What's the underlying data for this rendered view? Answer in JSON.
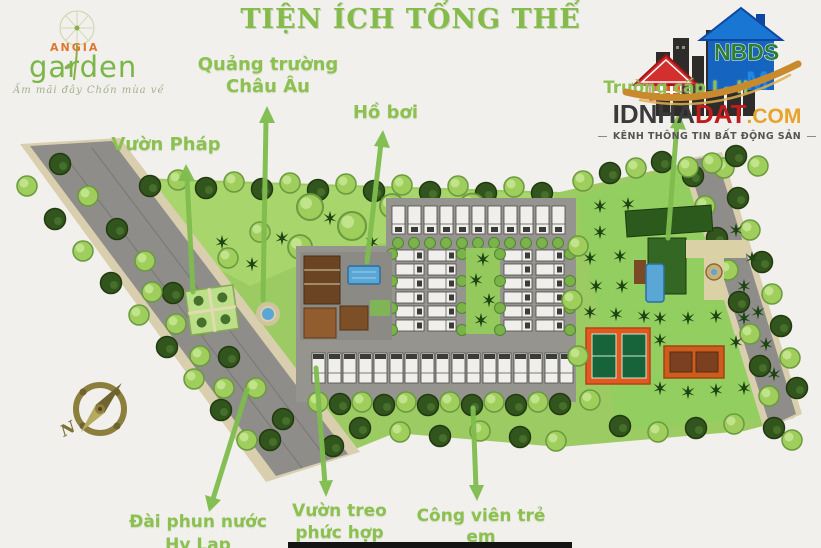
{
  "title": "TIỆN ÍCH TỔNG THỂ",
  "angia_logo": {
    "brand_primary": "ANGIA",
    "brand_secondary": "garden",
    "tagline": "Ấm mãi đây Chốn mùa về"
  },
  "nbds_logo": {
    "house_acronym": "NBDS",
    "house_letter": "M",
    "site_prefix": "IDNHA",
    "site_accent": "DAT",
    "site_tld": ".COM",
    "tagline": "KÊNH THÔNG TIN BẤT ĐỘNG SẢN"
  },
  "compass": {
    "north": "N"
  },
  "callouts": {
    "french_garden": {
      "label": "Vườn Pháp"
    },
    "european_square": {
      "line1": "Quảng trường",
      "line2": "Châu Âu"
    },
    "swimming_pool": {
      "label": "Hồ bơi"
    },
    "school": {
      "label": "Trường cấp I - II"
    },
    "greek_fountain": {
      "line1": "Đài phun nước",
      "line2": "Hy Lạp"
    },
    "hanging_garden": {
      "line1": "Vườn treo",
      "line2": "phức hợp"
    },
    "children_park": {
      "label": "Công viên trẻ em"
    }
  },
  "colors": {
    "label_green": "#8cc152",
    "arrow_green": "#7fbd4e",
    "title_green": "#85bb4a",
    "lawn_green": "#9ccb63",
    "dark_tree_green": "#32551d",
    "road_gray": "#8e8d89",
    "road_edge_beige": "#d9cfae",
    "pool_blue": "#5aa7d6",
    "court_orange": "#e05a20",
    "court_green": "#17643a",
    "compass_olive": "#8c7e3d",
    "brand_orange": "#e0772e",
    "brand_green": "#7ab648",
    "site_name_red": "#c21b1b",
    "site_name_gold": "#e8a32a"
  }
}
